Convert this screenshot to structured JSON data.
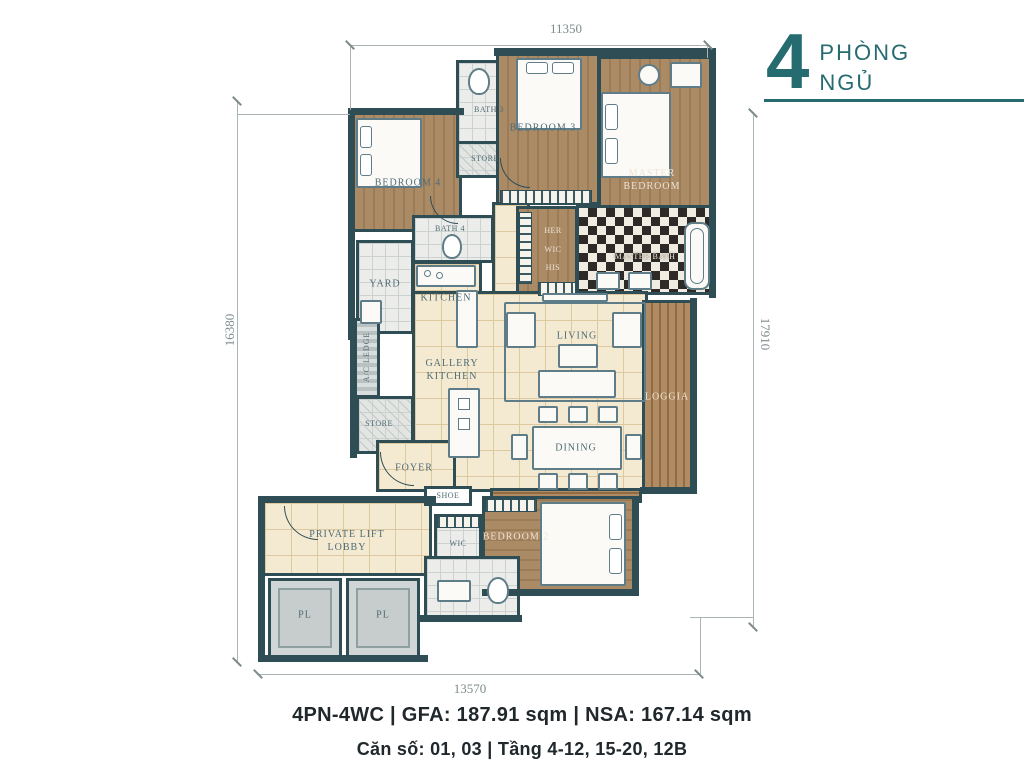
{
  "badge": {
    "number": "4",
    "word1": "PHÒNG",
    "word2": "NGỦ",
    "accent_color": "#266b70"
  },
  "dimensions": {
    "top": "11350",
    "left": "16380",
    "right": "17910",
    "bottom": "13570"
  },
  "rooms": {
    "bedroom4": "BEDROOM 4",
    "bath3": "BATH 3",
    "store_top": "STORE",
    "bedroom3": "BEDROOM 3",
    "master_bedroom": "MASTER BEDROOM",
    "bath4": "BATH 4",
    "her": "HER",
    "wic": "WIC",
    "his": "HIS",
    "master_bath": "MASTER BATH",
    "yard": "YARD",
    "kitchen": "KITCHEN",
    "gallery_kitchen": "GALLERY KITCHEN",
    "living": "LIVING",
    "loggia": "LOGGIA",
    "store_bottom": "STORE",
    "foyer": "FOYER",
    "dining": "DINING",
    "shoe": "SHOE",
    "ac_ledge": "A/C LEDGE",
    "private_lift_lobby": "PRIVATE LIFT LOBBY",
    "pl_left": "PL",
    "pl_right": "PL",
    "wic2": "WIC",
    "bedroom2": "BEDROOM 2"
  },
  "footer": {
    "line1": "4PN-4WC | GFA: 187.91 sqm | NSA: 167.14 sqm",
    "line2": "Căn số: 01, 03 | Tầng 4-12, 15-20, 12B"
  },
  "colors": {
    "wall": "#2e4d55",
    "wood": "#a5845f",
    "cream_floor": "#f4ead2",
    "accent": "#266b70"
  }
}
